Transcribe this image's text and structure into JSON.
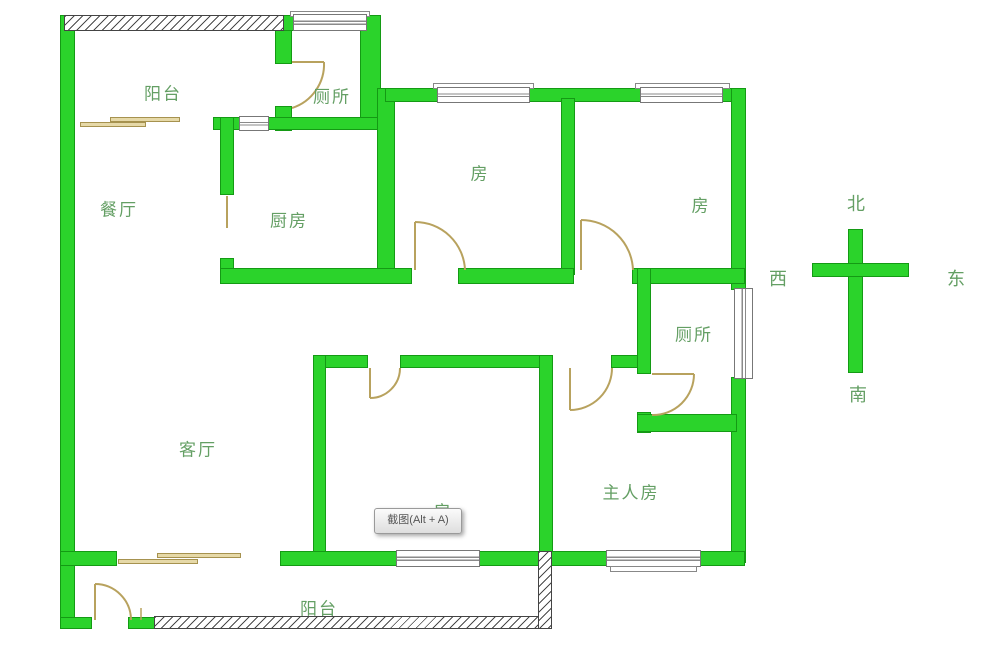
{
  "floor_plan": {
    "labels": [
      {
        "id": "balcony-top",
        "text": "阳台"
      },
      {
        "id": "toilet-top",
        "text": "厕所"
      },
      {
        "id": "dining",
        "text": "餐厅"
      },
      {
        "id": "kitchen",
        "text": "厨房"
      },
      {
        "id": "room-left",
        "text": "房"
      },
      {
        "id": "room-right",
        "text": "房"
      },
      {
        "id": "toilet-right",
        "text": "厕所"
      },
      {
        "id": "living",
        "text": "客厅"
      },
      {
        "id": "room-bottom",
        "text": "房"
      },
      {
        "id": "master",
        "text": "主人房"
      },
      {
        "id": "balcony-bottom",
        "text": "阳台"
      }
    ],
    "compass": {
      "north": "北",
      "south": "南",
      "west": "西",
      "east": "东"
    },
    "tooltip": {
      "text": "截图(Alt + A)"
    },
    "colors": {
      "wall_green": "#2bd32b",
      "wall_edge_green": "#149a14",
      "label_green": "#649f64",
      "door_wood": "#b8a25e",
      "hatch_line": "#4a4a4a",
      "tooltip_text": "#555555"
    }
  }
}
